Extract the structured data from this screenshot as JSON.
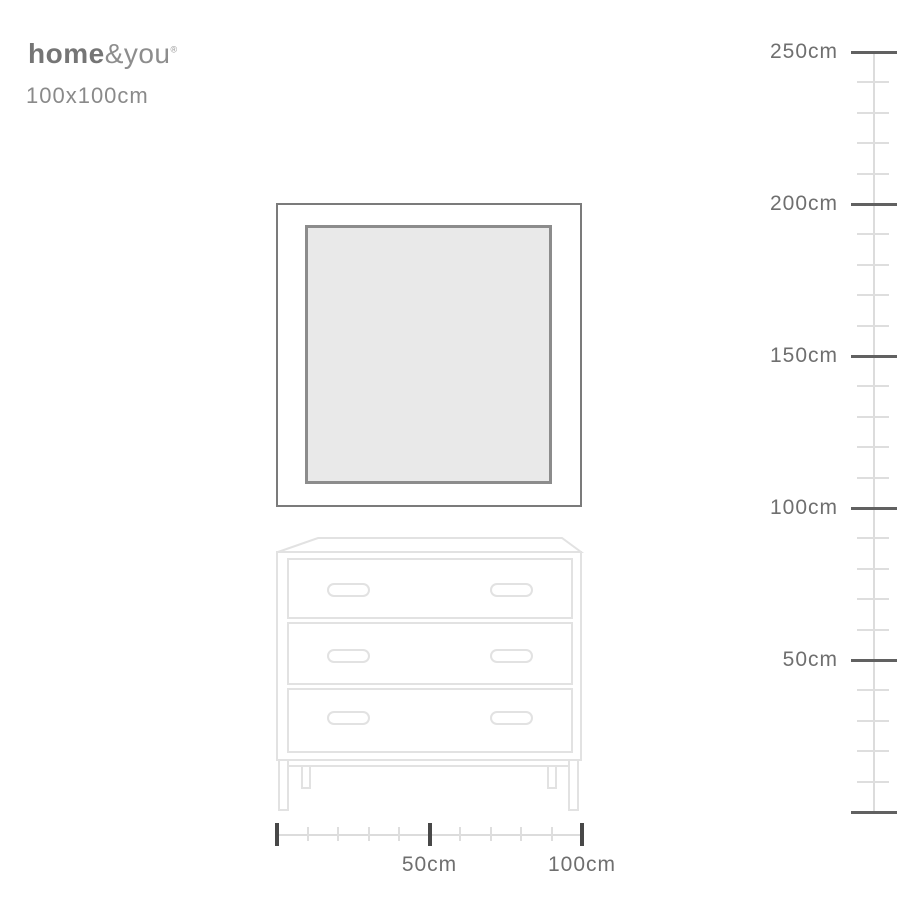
{
  "brand": {
    "bold": "home",
    "light": "&you",
    "mark": "®"
  },
  "product": {
    "size_label": "100x100cm"
  },
  "vertical_ruler": {
    "unit": "cm",
    "min_cm": 0,
    "max_cm": 250,
    "major_step_cm": 50,
    "minor_step_cm": 10,
    "minor_ticks_per_interval": 4,
    "major_labels": [
      "250cm",
      "200cm",
      "150cm",
      "100cm",
      "50cm",
      ""
    ]
  },
  "horizontal_ruler": {
    "unit": "cm",
    "min_cm": 0,
    "max_cm": 100,
    "major_step_cm": 50,
    "minor_step_cm": 10,
    "minor_ticks_per_interval": 4,
    "major_labels": [
      "",
      "50cm",
      "100cm"
    ]
  },
  "objects": {
    "mirror": {
      "description": "square framed mirror",
      "width_cm": 100,
      "height_cm": 100
    },
    "dresser": {
      "description": "three-drawer dresser on legs",
      "drawer_count": 3,
      "handles_per_drawer": 2
    }
  },
  "colors": {
    "logo_gray": "#757575",
    "text_gray": "#8a8a8a",
    "ruler_label_gray": "#6f6f6f",
    "ruler_line": "#dcdcdc",
    "major_tick": "#555555",
    "minor_tick": "#dedede",
    "mirror_frame": "#7b7b7b",
    "mirror_glass": "#e9e9e9",
    "furniture_outline": "#e2e2e2"
  }
}
